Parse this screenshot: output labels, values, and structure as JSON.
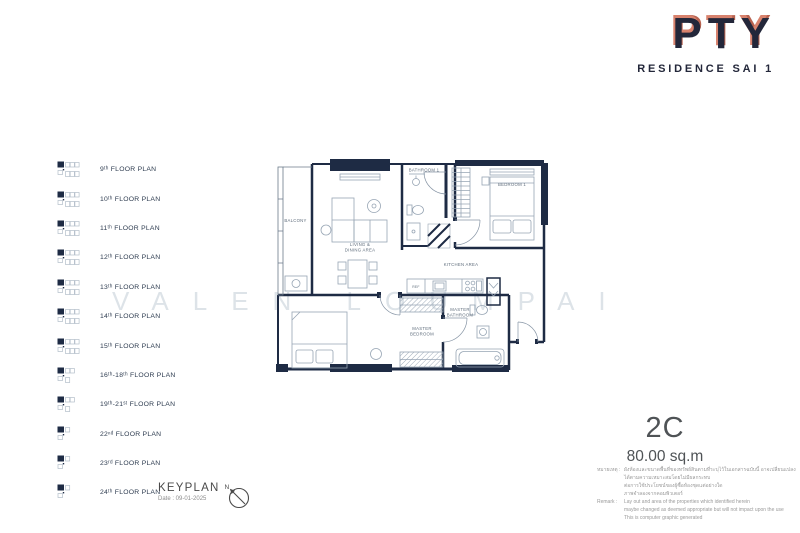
{
  "brand": {
    "name": "PTY",
    "tagline": "RESIDENCE SAI 1"
  },
  "sidebar": {
    "items": [
      {
        "label": "9ᵗʰ FLOOR PLAN"
      },
      {
        "label": "10ᵗʰ FLOOR PLAN"
      },
      {
        "label": "11ᵗʰ FLOOR PLAN"
      },
      {
        "label": "12ᵗʰ FLOOR PLAN"
      },
      {
        "label": "13ᵗʰ FLOOR PLAN"
      },
      {
        "label": "14ᵗʰ FLOOR PLAN"
      },
      {
        "label": "15ᵗʰ FLOOR PLAN"
      },
      {
        "label": "16ᵗʰ-18ᵗʰ FLOOR PLAN"
      },
      {
        "label": "19ᵗʰ-21ˢᵗ FLOOR PLAN"
      },
      {
        "label": "22ⁿᵈ FLOOR PLAN"
      },
      {
        "label": "23ʳᵈ FLOOR PLAN"
      },
      {
        "label": "24ᵗʰ FLOOR PLAN"
      }
    ]
  },
  "keyplan": {
    "title": "KEYPLAN",
    "date": "Date : 09-01-2025",
    "north": "N"
  },
  "watermark": "VALEN LOUMPAI",
  "unit": {
    "code": "2C",
    "area": "80.00 sq.m"
  },
  "plan": {
    "labels": {
      "balcony": "BALCONY",
      "living_line1": "LIVING &",
      "living_line2": "DINING AREA",
      "bathroom1": "BATHROOM 1",
      "bedroom1": "BEDROOM 1",
      "kitchen": "KITCHEN AREA",
      "ref": "REF",
      "master_bedroom_line1": "MASTER",
      "master_bedroom_line2": "BEDROOM",
      "master_bathroom_line1": "MASTER",
      "master_bathroom_line2": "BATHROOM"
    }
  },
  "remarks": {
    "thai_label": "หมายเหตุ :",
    "thai_lines": [
      "ผังห้องและขนาดพื้นที่ของทรัพย์สินตามที่ระบุไว้ในเอกสารฉบับนี้ อาจเปลี่ยนแปลงได้ตามความเหมาะสมโดยไม่มีผลกระทบ",
      "ต่อการใช้ประโยชน์ของผู้ซื้อห้องชุดแต่อย่างใด",
      "ภาพจำลองจากคอมพิวเตอร์"
    ],
    "en_label": "Remark :",
    "en_lines": [
      "Lay out and area of the properties which identified herein",
      "maybe changed as deemed appropriate but will not impact upon the use",
      "This is computer graphic generated"
    ]
  },
  "colors": {
    "wall": "#1e2b44",
    "copper": "#d8826d",
    "furniture_line": "#97a5b4",
    "plan_label": "#5f6d7c"
  }
}
